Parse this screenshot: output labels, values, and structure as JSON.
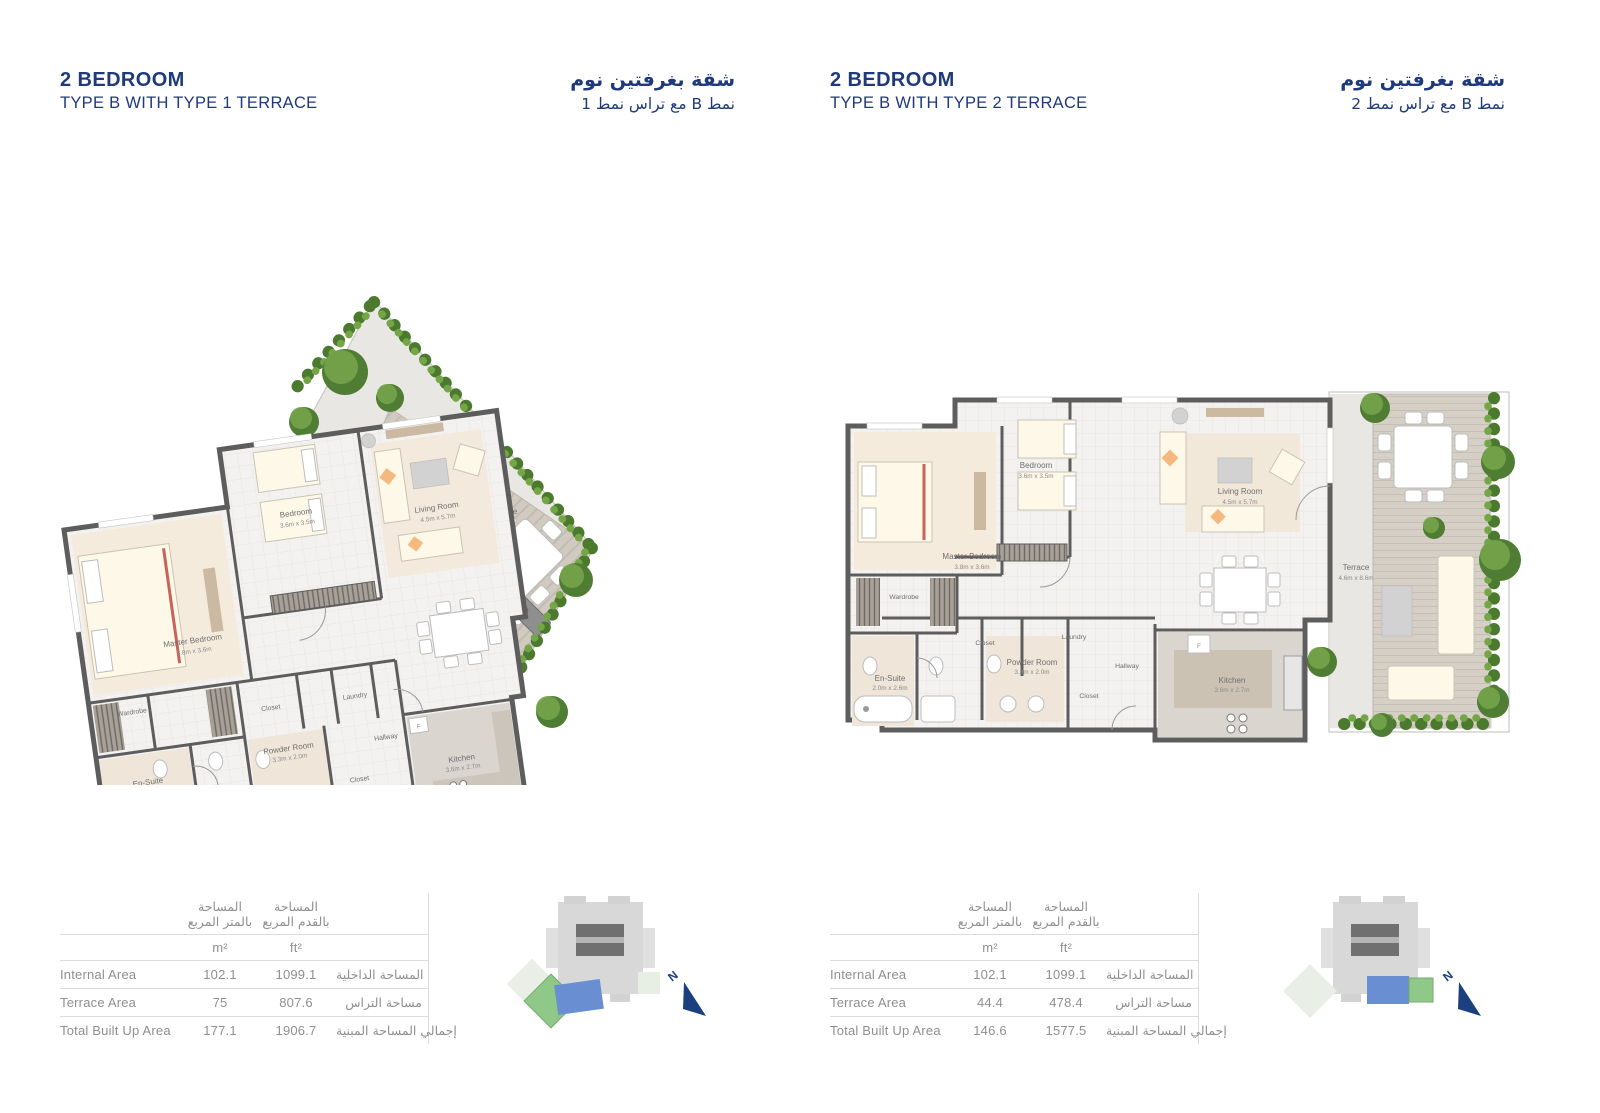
{
  "colors": {
    "title_navy": "#1e3a7d",
    "table_text": "#8f8f8f",
    "compass_navy": "#1c3f7f",
    "locator_unit_blue": "#6a8ed2",
    "locator_terrace_green": "#8fc888",
    "wall_gray": "#5d5d5d",
    "hedge_green": "#4b7a2f"
  },
  "panels": [
    {
      "title": {
        "en1": "2 BEDROOM",
        "en2": "TYPE B WITH TYPE 1 TERRACE",
        "ar1": "شقة بغرفتين نوم",
        "ar2": "نمط B مع تراس نمط 1"
      },
      "plan": {
        "rooms": {
          "master": {
            "name": "Master Bedroom",
            "dims": "3.8m x 3.6m"
          },
          "bedroom": {
            "name": "Bedroom",
            "dims": "3.6m x 3.5m"
          },
          "living": {
            "name": "Living Room",
            "dims": "4.5m x 5.7m"
          },
          "terrace": {
            "name": "Terrace",
            "dims": ""
          },
          "kitchen": {
            "name": "Kitchen",
            "dims": "3.6m x 2.7m"
          },
          "ensuite": {
            "name": "En-Suite",
            "dims": "2.0m x 2.6m"
          },
          "powder": {
            "name": "Powder Room",
            "dims": "3.3m x 2.0m"
          },
          "wardrobe": {
            "name": "Wardrobe"
          },
          "closet_a": {
            "name": "Closet"
          },
          "closet_b": {
            "name": "Closet"
          },
          "laundry": {
            "name": "Laundry"
          },
          "hallway": {
            "name": "Hallway"
          }
        },
        "fixture_f": "F"
      },
      "table": {
        "col_m_ar1": "المساحة",
        "col_m_ar2": "بالمتر المربع",
        "col_ft_ar1": "المساحة",
        "col_ft_ar2": "بالقدم المربع",
        "unit_m": "m²",
        "unit_ft": "ft²",
        "rows": [
          {
            "en": "Internal Area",
            "m2": "102.1",
            "ft2": "1099.1",
            "ar": "المساحة الداخلية"
          },
          {
            "en": "Terrace Area",
            "m2": "75",
            "ft2": "807.6",
            "ar": "مساحة التراس"
          },
          {
            "en": "Total Built Up Area",
            "m2": "177.1",
            "ft2": "1906.7",
            "ar": "إجمالي المساحة المبنية"
          }
        ]
      },
      "compass": "N"
    },
    {
      "title": {
        "en1": "2 BEDROOM",
        "en2": "TYPE B WITH TYPE 2 TERRACE",
        "ar1": "شقة بغرفتين نوم",
        "ar2": "نمط B مع تراس نمط 2"
      },
      "plan": {
        "rooms": {
          "master": {
            "name": "Master Bedroom",
            "dims": "3.8m x 3.6m"
          },
          "bedroom": {
            "name": "Bedroom",
            "dims": "3.6m x 3.5m"
          },
          "living": {
            "name": "Living Room",
            "dims": "4.5m x 5.7m"
          },
          "terrace": {
            "name": "Terrace",
            "dims": "4.6m x 8.6m"
          },
          "kitchen": {
            "name": "Kitchen",
            "dims": "3.6m x 2.7m"
          },
          "ensuite": {
            "name": "En-Suite",
            "dims": "2.0m x 2.6m"
          },
          "powder": {
            "name": "Powder Room",
            "dims": "3.3m x 2.0m"
          },
          "wardrobe": {
            "name": "Wardrobe"
          },
          "closet_a": {
            "name": "Closet"
          },
          "closet_b": {
            "name": "Closet"
          },
          "laundry": {
            "name": "Laundry"
          },
          "hallway": {
            "name": "Hallway"
          }
        },
        "fixture_f": "F"
      },
      "table": {
        "col_m_ar1": "المساحة",
        "col_m_ar2": "بالمتر المربع",
        "col_ft_ar1": "المساحة",
        "col_ft_ar2": "بالقدم المربع",
        "unit_m": "m²",
        "unit_ft": "ft²",
        "rows": [
          {
            "en": "Internal Area",
            "m2": "102.1",
            "ft2": "1099.1",
            "ar": "المساحة الداخلية"
          },
          {
            "en": "Terrace Area",
            "m2": "44.4",
            "ft2": "478.4",
            "ar": "مساحة التراس"
          },
          {
            "en": "Total Built Up Area",
            "m2": "146.6",
            "ft2": "1577.5",
            "ar": "إجمالي المساحة المبنية"
          }
        ]
      },
      "compass": "N"
    }
  ]
}
